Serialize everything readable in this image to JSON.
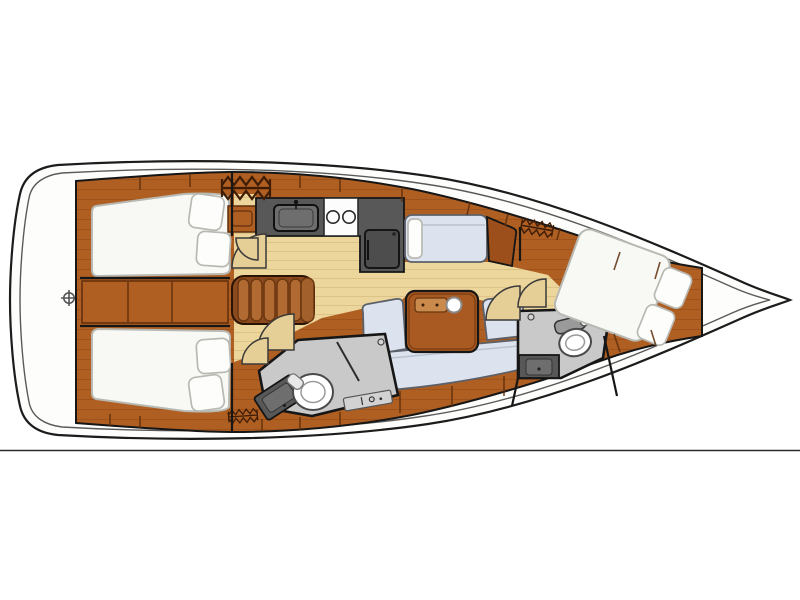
{
  "meta": {
    "title": "Sailing yacht interior layout plan",
    "type": "yacht-floor-plan",
    "orientation": {
      "bow": "right",
      "stern": "left"
    }
  },
  "rooms": {
    "aft_cabin_port": {
      "label": "Aft double cabin, port side"
    },
    "aft_cabin_starboard": {
      "label": "Aft double cabin, starboard side"
    },
    "salon": {
      "label": "Salon with L-shaped settee and table"
    },
    "galley": {
      "label": "Galley with sink, two-burner stove and refrigerator"
    },
    "nav_berth": {
      "label": "Side berth with chart table"
    },
    "aft_head": {
      "label": "Aft head with toilet, washbasin and shower"
    },
    "forward_head": {
      "label": "Forward head with toilet and washbasin"
    },
    "forward_cabin": {
      "label": "Forward owner cabin with island double bed"
    },
    "cockpit_transom": {
      "label": "Transom / swim platform"
    },
    "bow_deck": {
      "label": "Bow deck"
    }
  },
  "features": {
    "companionway_steps": "Companionway steps",
    "hanging_lockers": [
      "aft hanging locker",
      "forward hanging locker",
      "starboard aft hanging locker"
    ],
    "stern_marker": "circle-crosshair symbol",
    "door_swings": 6,
    "table_cupholder": "round cup holder on salon table"
  },
  "colors": {
    "background": "#ffffff",
    "deck_white": "#fdfdfc",
    "hull_outline": "#1c1c1c",
    "hull_inner_line": "#5a5a5a",
    "outline_dark": "#161616",
    "wood_mid": "#b05f22",
    "wood_dark": "#9c4f1a",
    "wood_grain": "#8a4312",
    "wood_seam": "#5f2f0c",
    "floor_tan": "#ecd69c",
    "floor_stripe": "#ddc387",
    "mattress_white": "#f8f8f5",
    "mattress_edge": "#b9b9b3",
    "pillow_white": "#fdfdfb",
    "cushion_blue": "#dde3ee",
    "cushion_edge": "#5b6069",
    "cushion_seam": "#b9c2d0",
    "head_floor_gray": "#c9c9c9",
    "appliance_dark": "#585858",
    "appliance_inner": "#6e6e6e",
    "door_wedge_tan": "#e6cf96",
    "hanger_brown": "#3f1d05",
    "leather_base": "#8a4a1e",
    "leather_ridge": "#b06a32",
    "leather_edge": "#6b3610",
    "table_wood": "#a85a22",
    "plaque_wood": "#c98a4b",
    "bottom_rule": "#2b2b2b"
  }
}
